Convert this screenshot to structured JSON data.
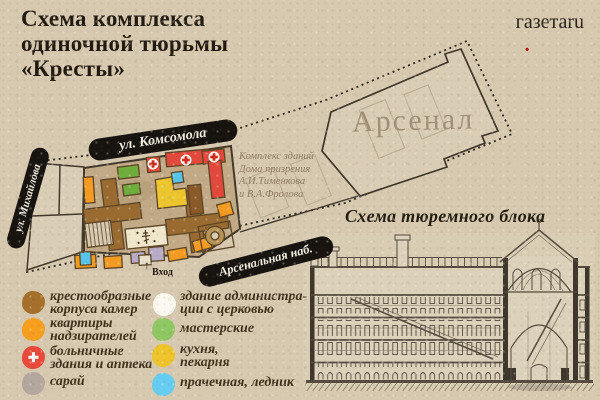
{
  "title": {
    "lines": [
      "Схема комплекса",
      "одиночной тюрьмы",
      "«Кресты»"
    ]
  },
  "logo": {
    "name": "газета",
    "dot": ".",
    "tld": "ru",
    "dot_color": "#b40f0f"
  },
  "map": {
    "streets": {
      "komsomola": "ул. Комсомола",
      "mikhailova": "ул. Михайлова",
      "arsenalnaya": "Арсенальная наб."
    },
    "area_label": "Арсенал",
    "caption_lines": [
      "Комплекс зданий",
      "Дома призрения",
      "А.И.Тименкова",
      "и В.А.Фролова"
    ],
    "entrance": {
      "arrow": "↑",
      "label": "Вход"
    }
  },
  "section": {
    "title": "Схема тюремного блока"
  },
  "legend": {
    "left": [
      {
        "color": "#a4702c",
        "symbol": "",
        "line1": "крестообразные",
        "line2": "корпуса камер"
      },
      {
        "color": "#f79e1f",
        "symbol": "",
        "line1": "квартиры",
        "line2": "надзирателей"
      },
      {
        "color": "#e8493a",
        "symbol": "✚",
        "line1": "больничные",
        "line2": "здания и аптека"
      },
      {
        "color": "#b4a89e",
        "symbol": "",
        "line1": "сарай",
        "line2": ""
      }
    ],
    "right": [
      {
        "color": "#fbf8f1",
        "symbol": "",
        "line1": "здание администра-",
        "line2": "ции с церковью"
      },
      {
        "color": "#8ec763",
        "symbol": "",
        "line1": "мастерские",
        "line2": ""
      },
      {
        "color": "#edc42c",
        "symbol": "",
        "line1": "кухня,",
        "line2": "пекарня"
      },
      {
        "color": "#66cdf2",
        "symbol": "",
        "line1": "прачечная, ледник",
        "line2": ""
      }
    ]
  },
  "colors": {
    "paper": "#d7c9b0",
    "prison_ground": "#c2aa87",
    "cross_buildings": "#9a6b31",
    "banner_bg": "#17130f",
    "ink": "#241c12"
  }
}
